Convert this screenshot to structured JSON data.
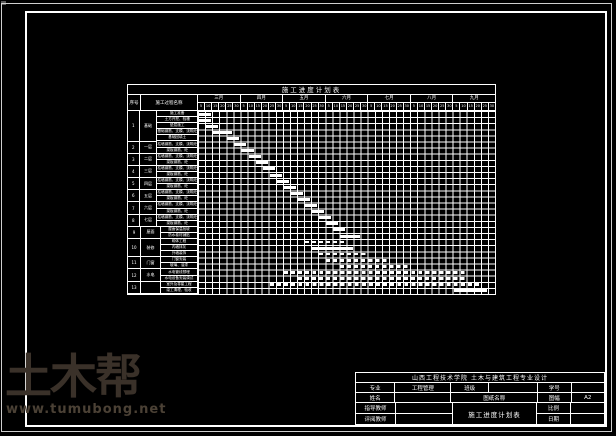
{
  "page": {
    "background": "#000000",
    "line_color": "#ffffff"
  },
  "watermark": {
    "brand": "土木帮",
    "site": "www.tumubong.net",
    "brand_color": "#3a3129",
    "site_color": "#4b4135"
  },
  "schedule": {
    "title": "施工进度计划表",
    "seq_header": "序号",
    "process_header": "施工过程名称",
    "months": [
      "三月",
      "四月",
      "五月",
      "六月",
      "七月",
      "八月",
      "九月"
    ],
    "days": [
      "5",
      "10",
      "15",
      "20",
      "25",
      "30"
    ],
    "groups": [
      {
        "seq": "1",
        "category": "基础",
        "tasks": [
          "施工准备",
          "土方开挖、验槽",
          "垫层施工",
          "基础钢筋、支模、浇筑砼",
          "基础回填土"
        ]
      },
      {
        "seq": "2",
        "category": "一层",
        "tasks": [
          "柱墙钢筋、支模、浇筑砼",
          "梁板钢筋、砼"
        ]
      },
      {
        "seq": "3",
        "category": "二层",
        "tasks": [
          "柱墙钢筋、支模、浇筑砼",
          "梁板钢筋、砼"
        ]
      },
      {
        "seq": "4",
        "category": "三层",
        "tasks": [
          "柱墙钢筋、支模、浇筑砼",
          "梁板钢筋、砼"
        ]
      },
      {
        "seq": "5",
        "category": "四层",
        "tasks": [
          "柱墙钢筋、支模、浇筑砼",
          "梁板钢筋、砼"
        ]
      },
      {
        "seq": "6",
        "category": "五层",
        "tasks": [
          "柱墙钢筋、支模、浇筑砼",
          "梁板钢筋、砼"
        ]
      },
      {
        "seq": "7",
        "category": "六层",
        "tasks": [
          "柱墙钢筋、支模、浇筑砼",
          "梁板钢筋、砼"
        ]
      },
      {
        "seq": "8",
        "category": "七层",
        "tasks": [
          "柱墙钢筋、支模、浇筑砼",
          "梁板钢筋、砼"
        ]
      },
      {
        "seq": "9",
        "category": "屋面",
        "tasks": [
          "屋面保温找坡",
          "防水卷材铺贴"
        ]
      },
      {
        "seq": "10",
        "category": "装修",
        "tasks": [
          "砌体工程",
          "内墙抹灰",
          "外墙装饰"
        ]
      },
      {
        "seq": "11",
        "category": "门窗",
        "tasks": [
          "门窗安装",
          "玻璃、油漆"
        ]
      },
      {
        "seq": "12",
        "category": "水电",
        "tasks": [
          "水电管线预埋",
          "水电设备安装调试"
        ]
      },
      {
        "seq": "13",
        "category": "",
        "tasks": [
          "室外及零星工程",
          "竣工清理、验收"
        ]
      }
    ],
    "bars": [
      {
        "r": 0,
        "s": 0,
        "l": 2,
        "dash": false
      },
      {
        "r": 1,
        "s": 0,
        "l": 2,
        "dash": false
      },
      {
        "r": 2,
        "s": 1,
        "l": 2,
        "dash": false
      },
      {
        "r": 3,
        "s": 2,
        "l": 3,
        "dash": false
      },
      {
        "r": 4,
        "s": 4,
        "l": 2,
        "dash": false
      },
      {
        "r": 5,
        "s": 5,
        "l": 2,
        "dash": false
      },
      {
        "r": 6,
        "s": 6,
        "l": 2,
        "dash": false
      },
      {
        "r": 7,
        "s": 7,
        "l": 2,
        "dash": false
      },
      {
        "r": 8,
        "s": 8,
        "l": 2,
        "dash": false
      },
      {
        "r": 9,
        "s": 9,
        "l": 2,
        "dash": false
      },
      {
        "r": 10,
        "s": 10,
        "l": 2,
        "dash": false
      },
      {
        "r": 11,
        "s": 11,
        "l": 2,
        "dash": false
      },
      {
        "r": 12,
        "s": 12,
        "l": 2,
        "dash": false
      },
      {
        "r": 13,
        "s": 13,
        "l": 2,
        "dash": false
      },
      {
        "r": 14,
        "s": 14,
        "l": 2,
        "dash": false
      },
      {
        "r": 15,
        "s": 15,
        "l": 2,
        "dash": false
      },
      {
        "r": 16,
        "s": 16,
        "l": 2,
        "dash": false
      },
      {
        "r": 17,
        "s": 17,
        "l": 2,
        "dash": false
      },
      {
        "r": 18,
        "s": 18,
        "l": 2,
        "dash": false
      },
      {
        "r": 19,
        "s": 19,
        "l": 2,
        "dash": false
      },
      {
        "r": 20,
        "s": 20,
        "l": 3,
        "dash": false
      },
      {
        "r": 21,
        "s": 15,
        "l": 6,
        "dash": true
      },
      {
        "r": 22,
        "s": 16,
        "l": 6,
        "dash": false
      },
      {
        "r": 23,
        "s": 17,
        "l": 7,
        "dash": true
      },
      {
        "r": 24,
        "s": 18,
        "l": 9,
        "dash": true
      },
      {
        "r": 25,
        "s": 20,
        "l": 10,
        "dash": true
      },
      {
        "r": 26,
        "s": 12,
        "l": 26,
        "dash": true
      },
      {
        "r": 27,
        "s": 14,
        "l": 24,
        "dash": true
      },
      {
        "r": 28,
        "s": 10,
        "l": 30,
        "dash": true
      },
      {
        "r": 29,
        "s": 36,
        "l": 5,
        "dash": false
      }
    ]
  },
  "title_block": {
    "school": "山西工程技术学院 土木与建筑工程专业设计",
    "major_label": "专业",
    "major_value": "工程管理",
    "class_label": "班级",
    "class_value": "",
    "id_label": "学号",
    "id_value": "",
    "name_label": "姓名",
    "name_value": "",
    "sheet_label": "图纸名称",
    "size_label": "图幅",
    "size_value": "A2",
    "advisor_label": "指导教师",
    "advisor_value": "",
    "scale_label": "比例",
    "scale_value": "",
    "reviewer_label": "评阅教师",
    "reviewer_value": "",
    "date_label": "日期",
    "date_value": "",
    "drawing_name": "施工进度计划表"
  }
}
